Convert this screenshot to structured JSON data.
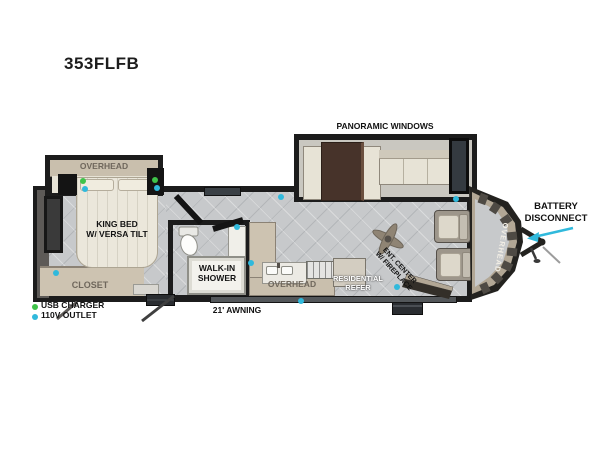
{
  "title": "353FLFB",
  "colors": {
    "usb_green": "#3fc34a",
    "outlet_cyan": "#30b9dc",
    "wall_black": "#1c1c1c",
    "cabinet_tan": "#cdc3b1"
  },
  "floorplan": {
    "living": {
      "panoramic_windows": "PANORAMIC WINDOWS",
      "ent_center_line1": "ENT. CENTER",
      "ent_center_line2": "W/ FIREPLACE",
      "overhead_front": "OVERHEAD"
    },
    "bedroom": {
      "overhead": "OVERHEAD",
      "king_bed_line1": "KING BED",
      "king_bed_line2": "W/ VERSA TILT",
      "closet": "CLOSET"
    },
    "bathroom": {
      "shower_line1": "WALK-IN",
      "shower_line2": "SHOWER"
    },
    "kitchen": {
      "overhead": "OVERHEAD",
      "refer_line1": "RESIDENTIAL",
      "refer_line2": "REFER"
    },
    "front": {
      "battery_line1": "BATTERY",
      "battery_line2": "DISCONNECT"
    },
    "awning": "21' AWNING",
    "legend": [
      {
        "label": "USB CHARGER"
      },
      {
        "label": "110V OUTLET"
      }
    ]
  }
}
